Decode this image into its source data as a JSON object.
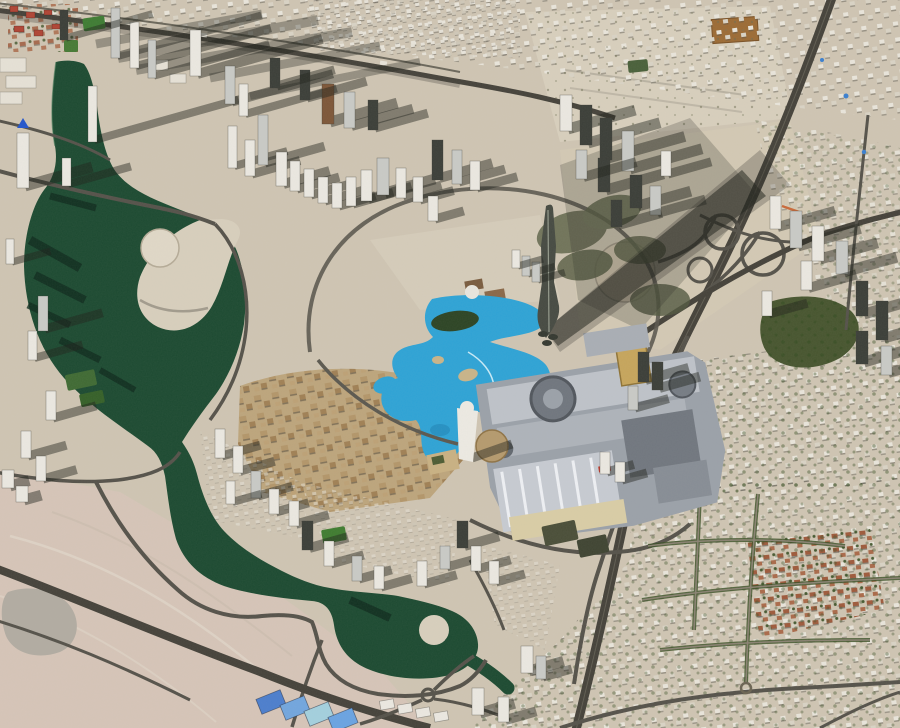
{
  "palette": {
    "sand_base": "#cfc5b3",
    "sand_light": "#d8cfbd",
    "sand_pink": "#d6c5b8",
    "sand_bright": "#e0d8c7",
    "urban_block": "#e9e5db",
    "urban_block2": "#d9d3c5",
    "road_dark": "#45423a",
    "road_mid": "#55524a",
    "road_light": "#8a8272",
    "rail": "#6a665a",
    "water_canal": "#1c4a31",
    "water_canal_dark": "#0f2c1e",
    "water_edge": "#2f6b49",
    "water_lake": "#2ea3d6",
    "water_lake_dark": "#1b7fb0",
    "water_lake_light": "#56c0e8",
    "shadow": "#23251e",
    "tree_green": "#394f24",
    "park_green": "#47552f",
    "grass_green": "#3f7c30",
    "white_roof": "#ebe8e1",
    "silver_roof": "#c9cac6",
    "dark_roof": "#3b3e38",
    "brown_roof": "#7d5638",
    "red_roof_a": "#9e5a3c",
    "red_roof_b": "#aa6a4a",
    "oldtown_a": "#b3966a",
    "oldtown_b": "#a08055",
    "oldtown_bg": "#bda57c",
    "mall_gray": "#9ba1a9",
    "mall_light": "#c2c6cc",
    "mall_mid": "#aeb3ba",
    "mall_dark": "#71777f",
    "cream": "#d9cda6",
    "gold": "#c6a55c",
    "pitch_brown": "#9c6b35",
    "mound_gray": "#b2aca2",
    "track_line": "#e0d5c8",
    "pool_blue": "#3a7fd0",
    "orange_accent": "#c96a3a",
    "burj_body": "#464a42",
    "island_green": "#2c4424",
    "island_tan": "#c9b489"
  },
  "scene": {
    "tower_colors": {
      "w": "#ebe8e1",
      "s": "#c9cac6",
      "d": "#3b3e38",
      "b": "#7d5638"
    },
    "towers": [
      [
        111,
        8,
        9,
        50,
        150,
        "s"
      ],
      [
        130,
        22,
        9,
        46,
        140,
        "w"
      ],
      [
        148,
        40,
        8,
        38,
        120,
        "s"
      ],
      [
        60,
        10,
        8,
        30,
        90,
        "d"
      ],
      [
        88,
        86,
        9,
        56,
        150,
        "w"
      ],
      [
        190,
        30,
        11,
        46,
        130,
        "w"
      ],
      [
        225,
        66,
        10,
        38,
        105,
        "s"
      ],
      [
        239,
        84,
        9,
        32,
        95,
        "w"
      ],
      [
        17,
        133,
        12,
        55,
        70,
        "w"
      ],
      [
        62,
        158,
        9,
        28,
        65,
        "w"
      ],
      [
        6,
        239,
        8,
        25,
        40,
        "w"
      ],
      [
        228,
        126,
        9,
        42,
        55,
        "w"
      ],
      [
        245,
        140,
        10,
        36,
        50,
        "w"
      ],
      [
        258,
        115,
        10,
        50,
        62,
        "s"
      ],
      [
        276,
        152,
        11,
        34,
        48,
        "w"
      ],
      [
        290,
        161,
        10,
        30,
        44,
        "w"
      ],
      [
        304,
        169,
        10,
        28,
        42,
        "w"
      ],
      [
        318,
        177,
        10,
        26,
        40,
        "w"
      ],
      [
        332,
        183,
        10,
        25,
        38,
        "w"
      ],
      [
        346,
        177,
        10,
        29,
        42,
        "w"
      ],
      [
        361,
        170,
        11,
        31,
        45,
        "w"
      ],
      [
        377,
        158,
        12,
        37,
        52,
        "s"
      ],
      [
        396,
        168,
        10,
        30,
        40,
        "w"
      ],
      [
        413,
        177,
        10,
        25,
        35,
        "w"
      ],
      [
        322,
        84,
        12,
        40,
        70,
        "b"
      ],
      [
        344,
        92,
        11,
        36,
        64,
        "s"
      ],
      [
        300,
        70,
        10,
        30,
        62,
        "d"
      ],
      [
        270,
        58,
        10,
        30,
        60,
        "d"
      ],
      [
        368,
        100,
        10,
        30,
        55,
        "d"
      ],
      [
        432,
        140,
        11,
        40,
        55,
        "d"
      ],
      [
        452,
        150,
        10,
        34,
        48,
        "s"
      ],
      [
        470,
        161,
        10,
        29,
        42,
        "w"
      ],
      [
        428,
        196,
        10,
        25,
        30,
        "w"
      ],
      [
        560,
        95,
        12,
        36,
        70,
        "w"
      ],
      [
        580,
        105,
        12,
        40,
        75,
        "d"
      ],
      [
        600,
        118,
        12,
        42,
        80,
        "d"
      ],
      [
        622,
        131,
        12,
        40,
        75,
        "s"
      ],
      [
        598,
        158,
        12,
        34,
        60,
        "d"
      ],
      [
        576,
        150,
        11,
        29,
        55,
        "s"
      ],
      [
        630,
        175,
        12,
        33,
        55,
        "d"
      ],
      [
        650,
        186,
        11,
        29,
        50,
        "s"
      ],
      [
        611,
        200,
        11,
        27,
        45,
        "d"
      ],
      [
        661,
        151,
        10,
        25,
        45,
        "w"
      ],
      [
        770,
        196,
        11,
        33,
        60,
        "w"
      ],
      [
        790,
        211,
        12,
        37,
        65,
        "s"
      ],
      [
        812,
        226,
        12,
        35,
        60,
        "w"
      ],
      [
        836,
        241,
        12,
        33,
        55,
        "s"
      ],
      [
        801,
        261,
        11,
        29,
        50,
        "w"
      ],
      [
        856,
        281,
        12,
        35,
        55,
        "d"
      ],
      [
        876,
        301,
        12,
        39,
        60,
        "d"
      ],
      [
        856,
        331,
        12,
        33,
        50,
        "d"
      ],
      [
        881,
        346,
        11,
        29,
        45,
        "s"
      ],
      [
        762,
        291,
        10,
        25,
        40,
        "w"
      ],
      [
        38,
        296,
        10,
        35,
        60,
        "s"
      ],
      [
        28,
        331,
        9,
        29,
        50,
        "w"
      ],
      [
        46,
        391,
        10,
        29,
        45,
        "w"
      ],
      [
        21,
        431,
        10,
        27,
        40,
        "w"
      ],
      [
        36,
        456,
        10,
        25,
        35,
        "w"
      ],
      [
        2,
        470,
        12,
        18,
        20,
        "w"
      ],
      [
        16,
        486,
        12,
        16,
        18,
        "w"
      ],
      [
        215,
        429,
        10,
        29,
        40,
        "w"
      ],
      [
        233,
        446,
        10,
        27,
        36,
        "w"
      ],
      [
        251,
        471,
        10,
        27,
        36,
        "s"
      ],
      [
        269,
        489,
        10,
        25,
        34,
        "w"
      ],
      [
        289,
        501,
        10,
        25,
        34,
        "w"
      ],
      [
        226,
        481,
        9,
        23,
        30,
        "w"
      ],
      [
        302,
        521,
        11,
        29,
        40,
        "d"
      ],
      [
        324,
        541,
        10,
        25,
        34,
        "w"
      ],
      [
        352,
        556,
        10,
        25,
        34,
        "s"
      ],
      [
        374,
        566,
        10,
        23,
        32,
        "w"
      ],
      [
        417,
        561,
        10,
        25,
        34,
        "w"
      ],
      [
        440,
        546,
        10,
        23,
        30,
        "s"
      ],
      [
        457,
        521,
        11,
        27,
        36,
        "d"
      ],
      [
        471,
        546,
        10,
        25,
        34,
        "w"
      ],
      [
        489,
        561,
        10,
        23,
        30,
        "w"
      ],
      [
        521,
        646,
        12,
        27,
        36,
        "w"
      ],
      [
        472,
        688,
        12,
        27,
        36,
        "w"
      ],
      [
        498,
        697,
        11,
        25,
        32,
        "w"
      ],
      [
        536,
        656,
        10,
        23,
        30,
        "s"
      ],
      [
        522,
        256,
        8,
        20,
        28,
        "s"
      ],
      [
        532,
        262,
        8,
        20,
        28,
        "s"
      ],
      [
        512,
        250,
        8,
        18,
        26,
        "w"
      ],
      [
        638,
        352,
        11,
        30,
        45,
        "d"
      ],
      [
        652,
        362,
        11,
        28,
        42,
        "d"
      ],
      [
        628,
        386,
        10,
        24,
        35,
        "s"
      ],
      [
        600,
        452,
        10,
        22,
        28,
        "w"
      ],
      [
        615,
        462,
        10,
        20,
        26,
        "w"
      ]
    ],
    "sheds": [
      [
        380,
        700
      ],
      [
        398,
        704
      ],
      [
        416,
        708
      ],
      [
        434,
        712
      ]
    ],
    "warehouses": [
      [
        258,
        694,
        26,
        16,
        -22,
        "#4c7ecd"
      ],
      [
        282,
        700,
        26,
        16,
        -22,
        "#72a6de"
      ],
      [
        306,
        706,
        26,
        16,
        -22,
        "#a3d0de"
      ],
      [
        330,
        712,
        26,
        16,
        -22,
        "#6aa3e2"
      ]
    ],
    "greens": [
      [
        66,
        372,
        30,
        16,
        -12,
        "#3f6a33"
      ],
      [
        80,
        392,
        24,
        13,
        -12,
        "#356028"
      ],
      [
        322,
        528,
        24,
        14,
        -10,
        "#3f7c30"
      ],
      [
        543,
        523,
        34,
        20,
        -12,
        "#4a4e38"
      ],
      [
        578,
        537,
        30,
        18,
        -12,
        "#3f4432"
      ],
      [
        83,
        17,
        22,
        13,
        -8,
        "#3e7c33"
      ],
      [
        64,
        40,
        14,
        12,
        0,
        "#467a35"
      ],
      [
        628,
        60,
        20,
        12,
        -6,
        "#49603a"
      ]
    ],
    "red_blocks": [
      [
        10,
        6,
        8,
        6
      ],
      [
        26,
        12,
        9,
        6
      ],
      [
        44,
        10,
        8,
        5
      ],
      [
        14,
        26,
        10,
        6
      ],
      [
        34,
        30,
        9,
        6
      ],
      [
        52,
        24,
        8,
        5
      ]
    ],
    "low_rise": [
      [
        0,
        58,
        26,
        14
      ],
      [
        6,
        76,
        30,
        12
      ],
      [
        0,
        92,
        22,
        12
      ],
      [
        150,
        60,
        18,
        10
      ],
      [
        170,
        74,
        16,
        9
      ]
    ]
  }
}
